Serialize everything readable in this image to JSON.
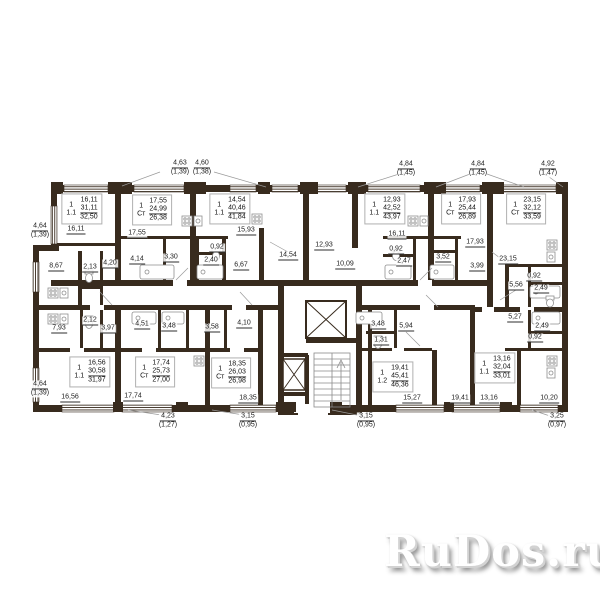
{
  "watermark": {
    "text": "RuDos.ru"
  },
  "plan": {
    "wall_color": "#382b1e",
    "apartments": [
      {
        "rooms": "1",
        "type": "1.1",
        "living": "16,11",
        "area": "31,11",
        "total": "32,50",
        "x": 82,
        "y": 209
      },
      {
        "rooms": "1",
        "type": "Ст",
        "living": "17,55",
        "area": "24,99",
        "total": "26,38",
        "x": 152,
        "y": 210
      },
      {
        "rooms": "1",
        "type": "1.1",
        "living": "14,54",
        "area": "40,46",
        "total": "41,84",
        "x": 230,
        "y": 209
      },
      {
        "rooms": "1",
        "type": "1.1",
        "living": "12,93",
        "area": "42,52",
        "total": "43,97",
        "x": 385,
        "y": 209
      },
      {
        "rooms": "1",
        "type": "Ст",
        "living": "17,93",
        "area": "25,44",
        "total": "26,89",
        "x": 461,
        "y": 209
      },
      {
        "rooms": "1",
        "type": "Ст",
        "living": "23,15",
        "area": "32,12",
        "total": "33,59",
        "x": 526,
        "y": 209
      },
      {
        "rooms": "1",
        "type": "1.1",
        "living": "16,56",
        "area": "30,58",
        "total": "31,97",
        "x": 90,
        "y": 372
      },
      {
        "rooms": "1",
        "type": "Ст",
        "living": "17,74",
        "area": "25,73",
        "total": "27,00",
        "x": 155,
        "y": 372
      },
      {
        "rooms": "1",
        "type": "Ст",
        "living": "18,35",
        "area": "26,03",
        "total": "26,98",
        "x": 231,
        "y": 373
      },
      {
        "rooms": "1",
        "type": "1.2",
        "living": "19,41",
        "area": "45,41",
        "total": "46,36",
        "x": 393,
        "y": 377
      },
      {
        "rooms": "1",
        "type": "1.1",
        "living": "13,16",
        "area": "32,04",
        "total": "33,01",
        "x": 495,
        "y": 368
      }
    ],
    "room_labels": [
      {
        "value": "16,11",
        "x": 76,
        "y": 230
      },
      {
        "value": "17,55",
        "x": 137,
        "y": 234
      },
      {
        "value": "15,93",
        "x": 246,
        "y": 231
      },
      {
        "value": "14,54",
        "x": 288,
        "y": 256
      },
      {
        "value": "12,93",
        "x": 324,
        "y": 246
      },
      {
        "value": "10,09",
        "x": 345,
        "y": 265
      },
      {
        "value": "16,11",
        "x": 397,
        "y": 235
      },
      {
        "value": "17,93",
        "x": 475,
        "y": 243
      },
      {
        "value": "23,15",
        "x": 508,
        "y": 260
      },
      {
        "value": "8,67",
        "x": 56,
        "y": 267
      },
      {
        "value": "2,13",
        "x": 90,
        "y": 268
      },
      {
        "value": "4,20",
        "x": 110,
        "y": 264
      },
      {
        "value": "4,14",
        "x": 137,
        "y": 260
      },
      {
        "value": "3,30",
        "x": 171,
        "y": 258
      },
      {
        "value": "0,92",
        "x": 217,
        "y": 248
      },
      {
        "value": "2,40",
        "x": 211,
        "y": 261
      },
      {
        "value": "6,67",
        "x": 241,
        "y": 266
      },
      {
        "value": "0,92",
        "x": 396,
        "y": 250
      },
      {
        "value": "2,47",
        "x": 404,
        "y": 262
      },
      {
        "value": "3,52",
        "x": 443,
        "y": 258
      },
      {
        "value": "3,99",
        "x": 477,
        "y": 267
      },
      {
        "value": "0,92",
        "x": 534,
        "y": 277
      },
      {
        "value": "5,56",
        "x": 516,
        "y": 286
      },
      {
        "value": "2,49",
        "x": 541,
        "y": 289
      },
      {
        "value": "5,27",
        "x": 515,
        "y": 318
      },
      {
        "value": "2,49",
        "x": 542,
        "y": 327
      },
      {
        "value": "0,92",
        "x": 535,
        "y": 338
      },
      {
        "value": "7,93",
        "x": 59,
        "y": 329
      },
      {
        "value": "2,12",
        "x": 90,
        "y": 321
      },
      {
        "value": "3,97",
        "x": 108,
        "y": 329
      },
      {
        "value": "4,51",
        "x": 142,
        "y": 325
      },
      {
        "value": "3,48",
        "x": 169,
        "y": 327
      },
      {
        "value": "3,58",
        "x": 212,
        "y": 328
      },
      {
        "value": "4,10",
        "x": 244,
        "y": 324
      },
      {
        "value": "3,48",
        "x": 378,
        "y": 325
      },
      {
        "value": "1,31",
        "x": 381,
        "y": 341
      },
      {
        "value": "5,94",
        "x": 406,
        "y": 327
      },
      {
        "value": "16,56",
        "x": 70,
        "y": 398
      },
      {
        "value": "17,74",
        "x": 133,
        "y": 397
      },
      {
        "value": "18,35",
        "x": 248,
        "y": 399
      },
      {
        "value": "15,27",
        "x": 412,
        "y": 399
      },
      {
        "value": "19,41",
        "x": 460,
        "y": 399
      },
      {
        "value": "13,16",
        "x": 489,
        "y": 399
      },
      {
        "value": "10,20",
        "x": 549,
        "y": 399
      }
    ],
    "dimensions": [
      {
        "value": "4,63",
        "sub": "(1,39)",
        "x": 180,
        "y": 168
      },
      {
        "value": "4,60",
        "sub": "(1,38)",
        "x": 202,
        "y": 168
      },
      {
        "value": "4,84",
        "sub": "(1,45)",
        "x": 406,
        "y": 169
      },
      {
        "value": "4,84",
        "sub": "(1,45)",
        "x": 478,
        "y": 169
      },
      {
        "value": "4,92",
        "sub": "(1,47)",
        "x": 548,
        "y": 169
      },
      {
        "value": "4,64",
        "sub": "(1,39)",
        "x": 40,
        "y": 231
      },
      {
        "value": "4,64",
        "sub": "(1,39)",
        "x": 40,
        "y": 389
      },
      {
        "value": "4,23",
        "sub": "(1,27)",
        "x": 168,
        "y": 421
      },
      {
        "value": "3,15",
        "sub": "(0,95)",
        "x": 248,
        "y": 421
      },
      {
        "value": "3,15",
        "sub": "(0,95)",
        "x": 366,
        "y": 421
      },
      {
        "value": "3,25",
        "sub": "(0,97)",
        "x": 557,
        "y": 421
      }
    ]
  }
}
